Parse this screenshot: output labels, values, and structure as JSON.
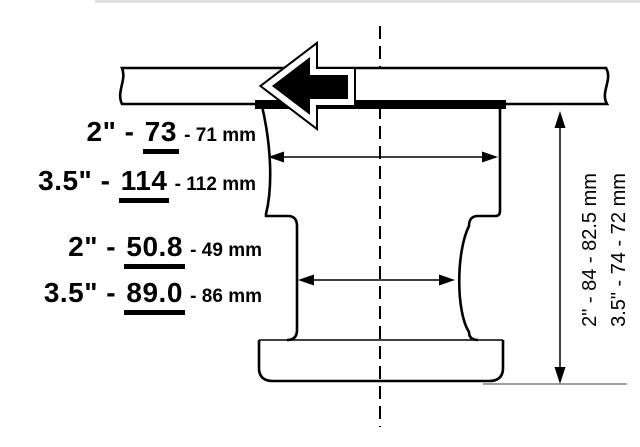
{
  "diagram": {
    "title": "tape spool cross-section with dimensions",
    "colors": {
      "line": "#000000",
      "background": "#ffffff",
      "tape_layer": "#000000",
      "direction_arrow": "#000000"
    },
    "labels": {
      "upper_width": {
        "rows": [
          {
            "prefix": "2\" - ",
            "value": "73",
            "metric": " - 71 mm"
          },
          {
            "prefix": "3.5\" - ",
            "value": "114",
            "metric": " - 112 mm"
          }
        ]
      },
      "hub_width": {
        "rows": [
          {
            "prefix": "2\" - ",
            "value": "50.8",
            "metric": " - 49 mm"
          },
          {
            "prefix": "3.5\" - ",
            "value": "89.0",
            "metric": " - 86 mm"
          }
        ]
      },
      "height": {
        "rows": [
          {
            "text": "2\" - 84 - 82.5 mm"
          },
          {
            "text": "3.5\" - 74 - 72 mm"
          }
        ]
      }
    }
  }
}
